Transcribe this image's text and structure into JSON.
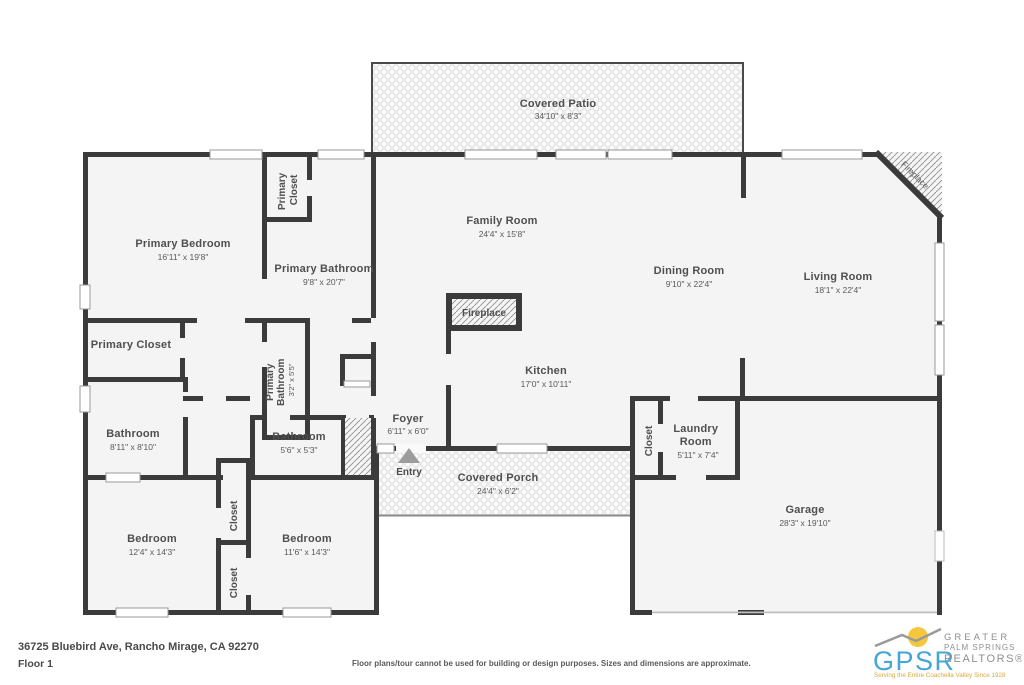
{
  "rooms": {
    "covered_patio": {
      "name": "Covered Patio",
      "dims": "34'10\" x 8'3\""
    },
    "family_room": {
      "name": "Family Room",
      "dims": "24'4\" x 15'8\""
    },
    "dining_room": {
      "name": "Dining Room",
      "dims": "9'10\" x 22'4\""
    },
    "living_room": {
      "name": "Living Room",
      "dims": "18'1\" x 22'4\""
    },
    "primary_bedroom": {
      "name": "Primary Bedroom",
      "dims": "16'11\" x 19'8\""
    },
    "primary_bathroom": {
      "name": "Primary Bathroom",
      "dims": "9'8\" x 20'7\""
    },
    "primary_closet_top": {
      "line1": "Primary",
      "line2": "Closet"
    },
    "primary_closet_left": {
      "name": "Primary Closet"
    },
    "primary_bathroom_small": {
      "line1": "Primary",
      "line2": "Bathroom",
      "dims": "3'2\" x 5'5\""
    },
    "kitchen": {
      "name": "Kitchen",
      "dims": "17'0\" x 10'11\""
    },
    "bathroom_hall": {
      "name": "Bathroom",
      "dims": "8'11\" x 8'10\""
    },
    "bathroom_small": {
      "name": "Bathroom",
      "dims": "5'6\" x 5'3\""
    },
    "foyer": {
      "name": "Foyer",
      "dims": "6'11\" x 6'0\""
    },
    "covered_porch": {
      "name": "Covered Porch",
      "dims": "24'4\" x 6'2\""
    },
    "laundry_room": {
      "line1": "Laundry",
      "line2": "Room",
      "dims": "5'11\" x 7'4\""
    },
    "closet_laundry": {
      "name": "Closet"
    },
    "garage": {
      "name": "Garage",
      "dims": "28'3\" x 19'10\""
    },
    "bedroom_left": {
      "name": "Bedroom",
      "dims": "12'4\" x 14'3\""
    },
    "bedroom_right": {
      "name": "Bedroom",
      "dims": "11'6\" x 14'3\""
    },
    "closet_upper": {
      "name": "Closet"
    },
    "closet_lower": {
      "name": "Closet"
    },
    "fireplace_center": {
      "name": "Fireplace"
    },
    "fireplace_corner": {
      "name": "Fireplace"
    },
    "entry": {
      "name": "Entry"
    }
  },
  "footer": {
    "address": "36725 Bluebird Ave, Rancho Mirage, CA 92270",
    "floor": "Floor 1",
    "disclaimer": "Floor plans/tour cannot be used for building or design purposes. Sizes and dimensions are approximate."
  },
  "logo": {
    "abbr": "GPSR",
    "line1": "GREATER",
    "line2": "PALM SPRINGS",
    "line3": "REALTORS®",
    "tagline": "Serving the Entire Coachella Valley Since 1928"
  },
  "colors": {
    "wall": "#3b3b3b",
    "floor": "#f4f4f4",
    "accent_blue": "#45a6d6",
    "sun_yellow": "#f7c63f",
    "logo_gray": "#8f8f8f",
    "tagline_gold": "#d9a93c"
  }
}
